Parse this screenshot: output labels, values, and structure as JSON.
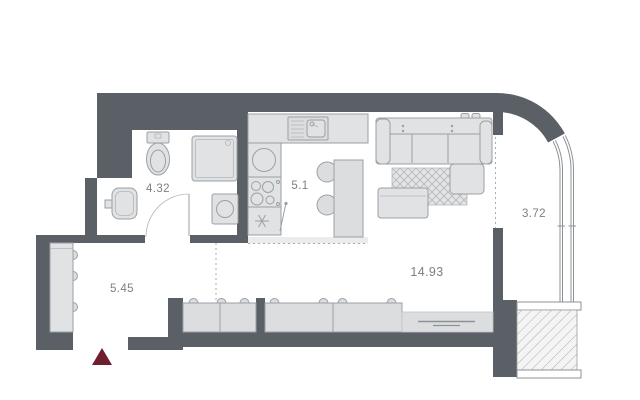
{
  "title": "Studio apartment floor plan",
  "rooms": {
    "bathroom": {
      "name": "bathroom",
      "area": "4.32"
    },
    "kitchen": {
      "name": "kitchen-zone",
      "area": "5.1"
    },
    "living": {
      "name": "living-room",
      "area": "14.93"
    },
    "hallway": {
      "name": "hallway",
      "area": "5.45"
    },
    "balcony": {
      "name": "balcony",
      "area": "3.72"
    }
  },
  "marker": {
    "entrance": "entrance-direction-triangle"
  },
  "colors": {
    "wall": "#5a6066",
    "furniture-fill": "#e1e2e4",
    "furniture-stroke": "#9aa0a4",
    "label": "#7b8086",
    "entrance": "#6e1e2d",
    "bg": "#ffffff"
  }
}
